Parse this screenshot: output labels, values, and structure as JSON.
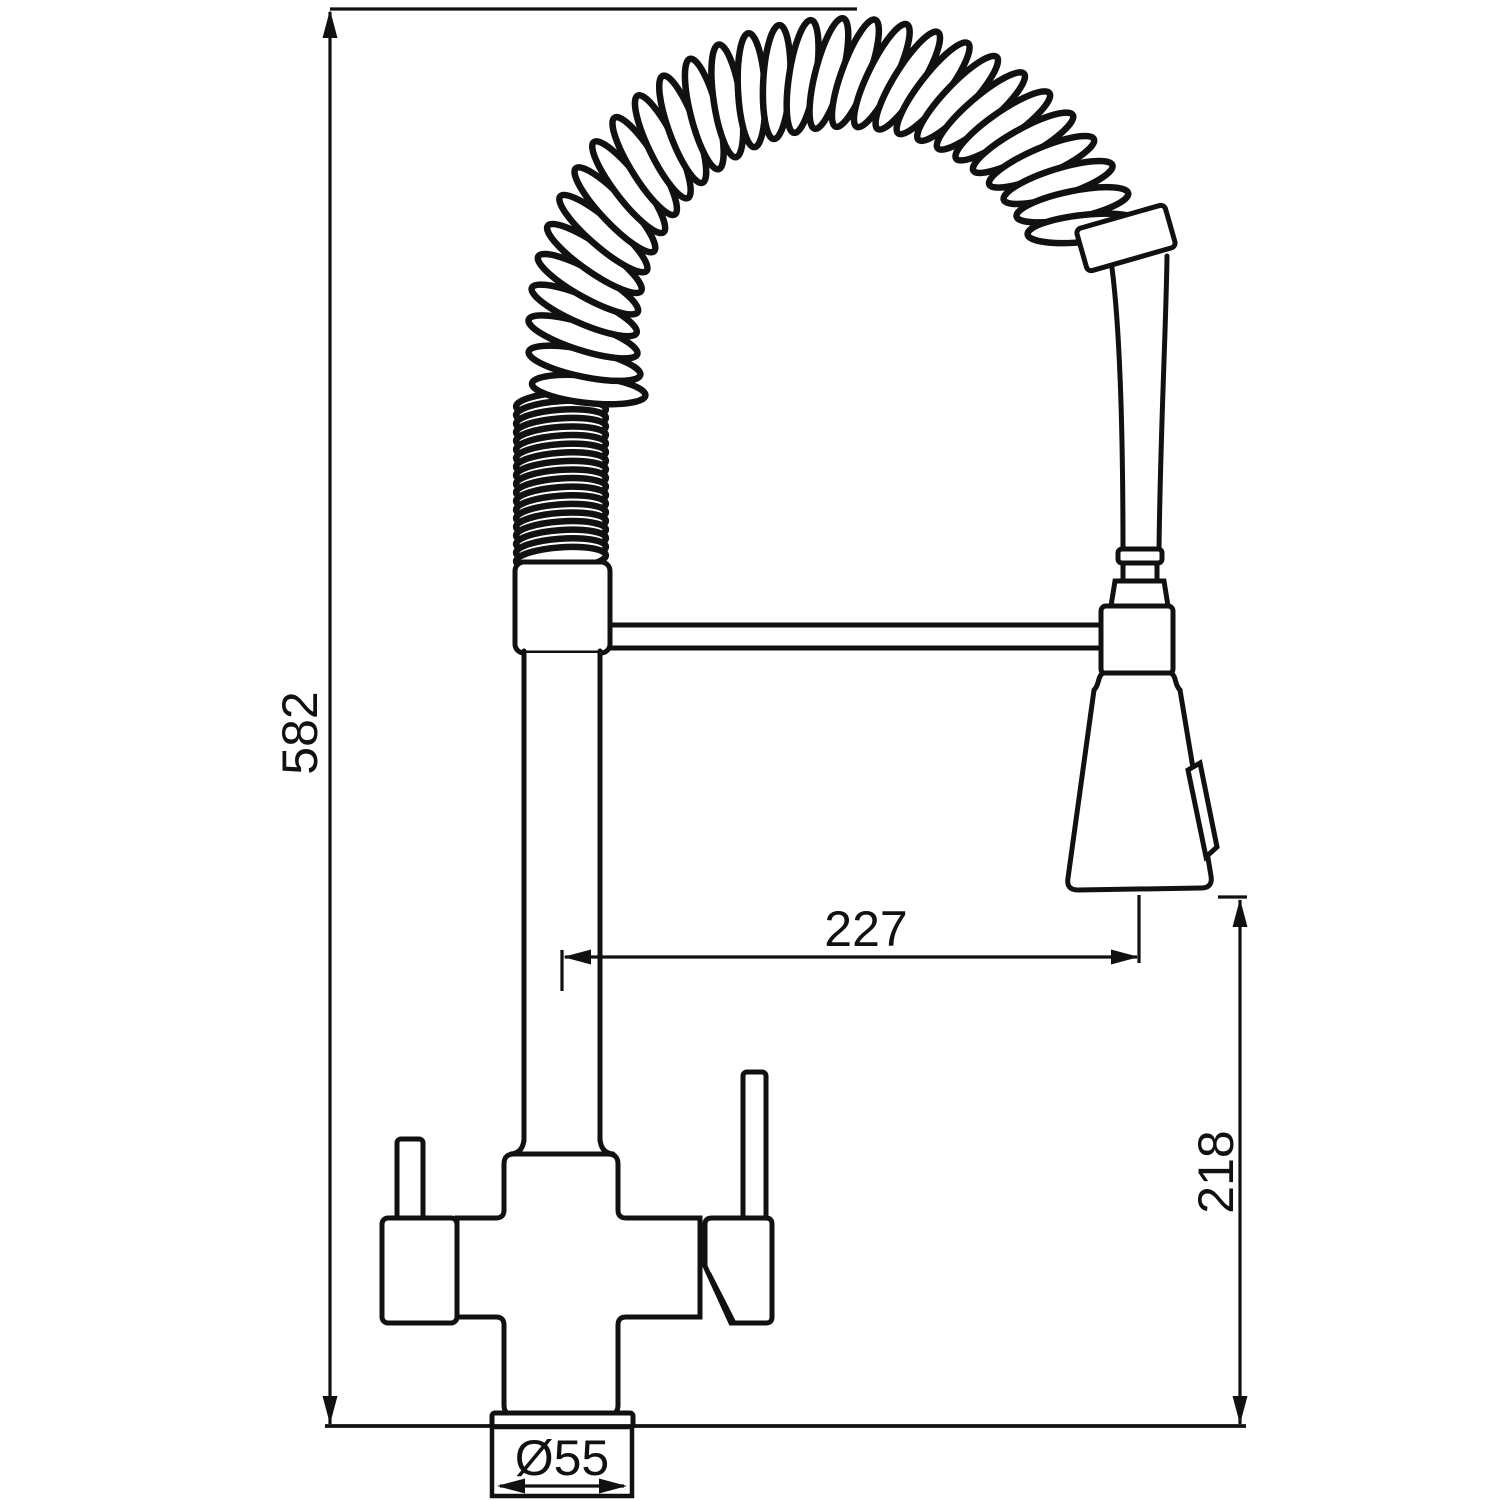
{
  "dimensions": {
    "overall_height": "582",
    "spout_reach": "227",
    "spray_outlet_height": "218",
    "base_diameter": "Ø55"
  },
  "colors": {
    "line": "#111111",
    "background": "#ffffff"
  }
}
